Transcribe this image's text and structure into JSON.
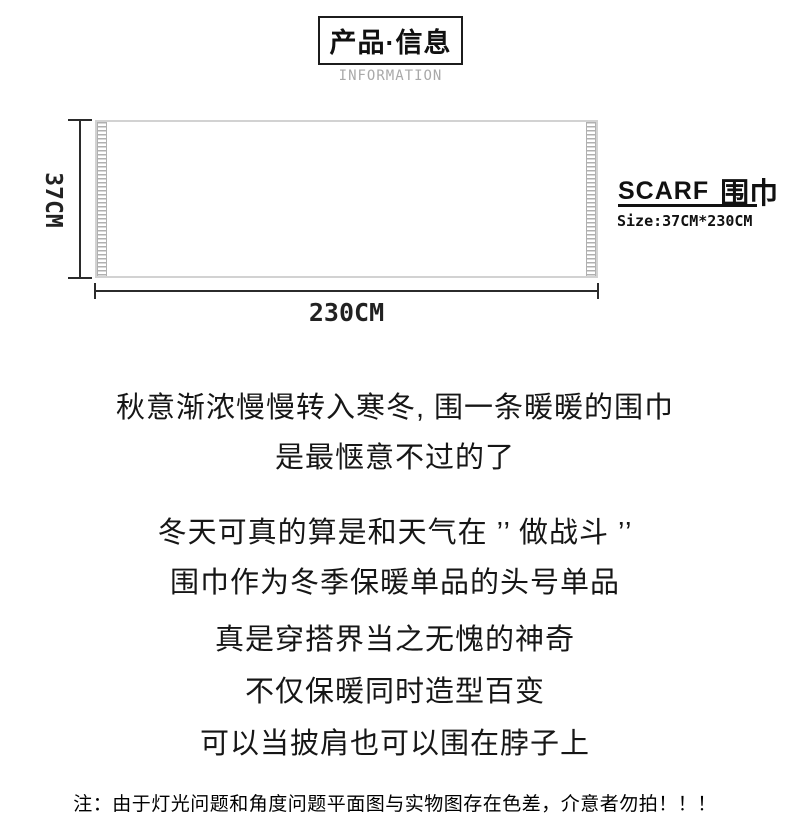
{
  "header": {
    "title": "产品·信息",
    "subtitle": "INFORMATION"
  },
  "diagram": {
    "height_label": "37CM",
    "width_label": "230CM",
    "product_en": "SCARF",
    "product_cn": "围巾",
    "size_label": "Size:37CM*230CM"
  },
  "body": {
    "lines": [
      "秋意渐浓慢慢转入寒冬, 围一条暖暖的围巾",
      "是最惬意不过的了",
      "冬天可真的算是和天气在 ’’ 做战斗 ’’",
      "围巾作为冬季保暖单品的头号单品",
      "真是穿搭界当之无愧的神奇",
      "不仅保暖同时造型百变",
      "可以当披肩也可以围在脖子上"
    ]
  },
  "footer": {
    "note": "注：由于灯光问题和角度问题平面图与实物图存在色差，介意者勿拍！！！"
  },
  "colors": {
    "text": "#141414",
    "muted_gray": "#a9a9a9",
    "dimension_line": "#2b2b2b",
    "scarf_border": "#d2d2d2",
    "fringe_gray": "#b0b0b0",
    "background": "#ffffff"
  }
}
